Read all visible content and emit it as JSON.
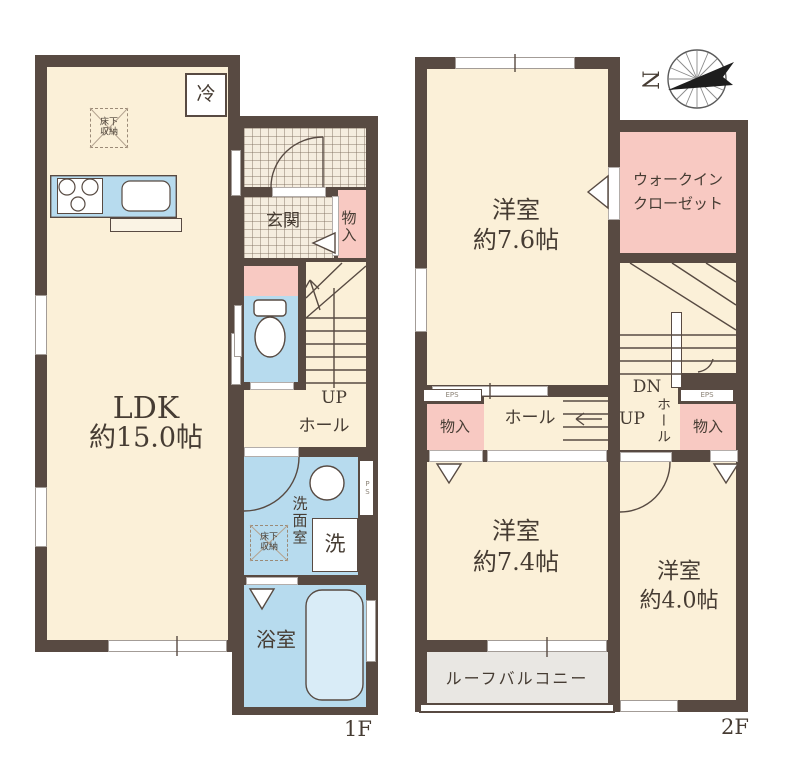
{
  "title": "2-story residential floor plan",
  "colors": {
    "wall": "#584A42",
    "room_cream": "#FBF0D8",
    "water_blue": "#B7DBEE",
    "closet_pink": "#F8C9C2",
    "balcony_gray": "#E9E7E3",
    "text": "#463C33"
  },
  "f1": {
    "floor_label": "1F",
    "ldk_line1": "LDK",
    "ldk_line2": "約15.0帖",
    "fridge": "冷",
    "underfloor": "床下収納",
    "underfloor2": "床下収納",
    "entrance": "玄関",
    "closet": "物入",
    "up": "UP",
    "hall": "ホール",
    "washroom": "洗面室",
    "laundry": "洗",
    "ps": "PS",
    "bath": "浴室"
  },
  "f2": {
    "floor_label": "2F",
    "north": "N",
    "room_a1": "洋室",
    "room_a2": "約7.6帖",
    "wic1": "ウォークイン",
    "wic2": "クローゼット",
    "dn": "DN",
    "up": "UP",
    "hall": "ホール",
    "hall_v": "ホール",
    "closet_l": "物入",
    "closet_r": "物入",
    "eps_l": "EPS",
    "eps_r": "EPS",
    "room_b1": "洋室",
    "room_b2": "約7.4帖",
    "room_c1": "洋室",
    "room_c2": "約4.0帖",
    "balcony": "ルーフバルコニー"
  }
}
